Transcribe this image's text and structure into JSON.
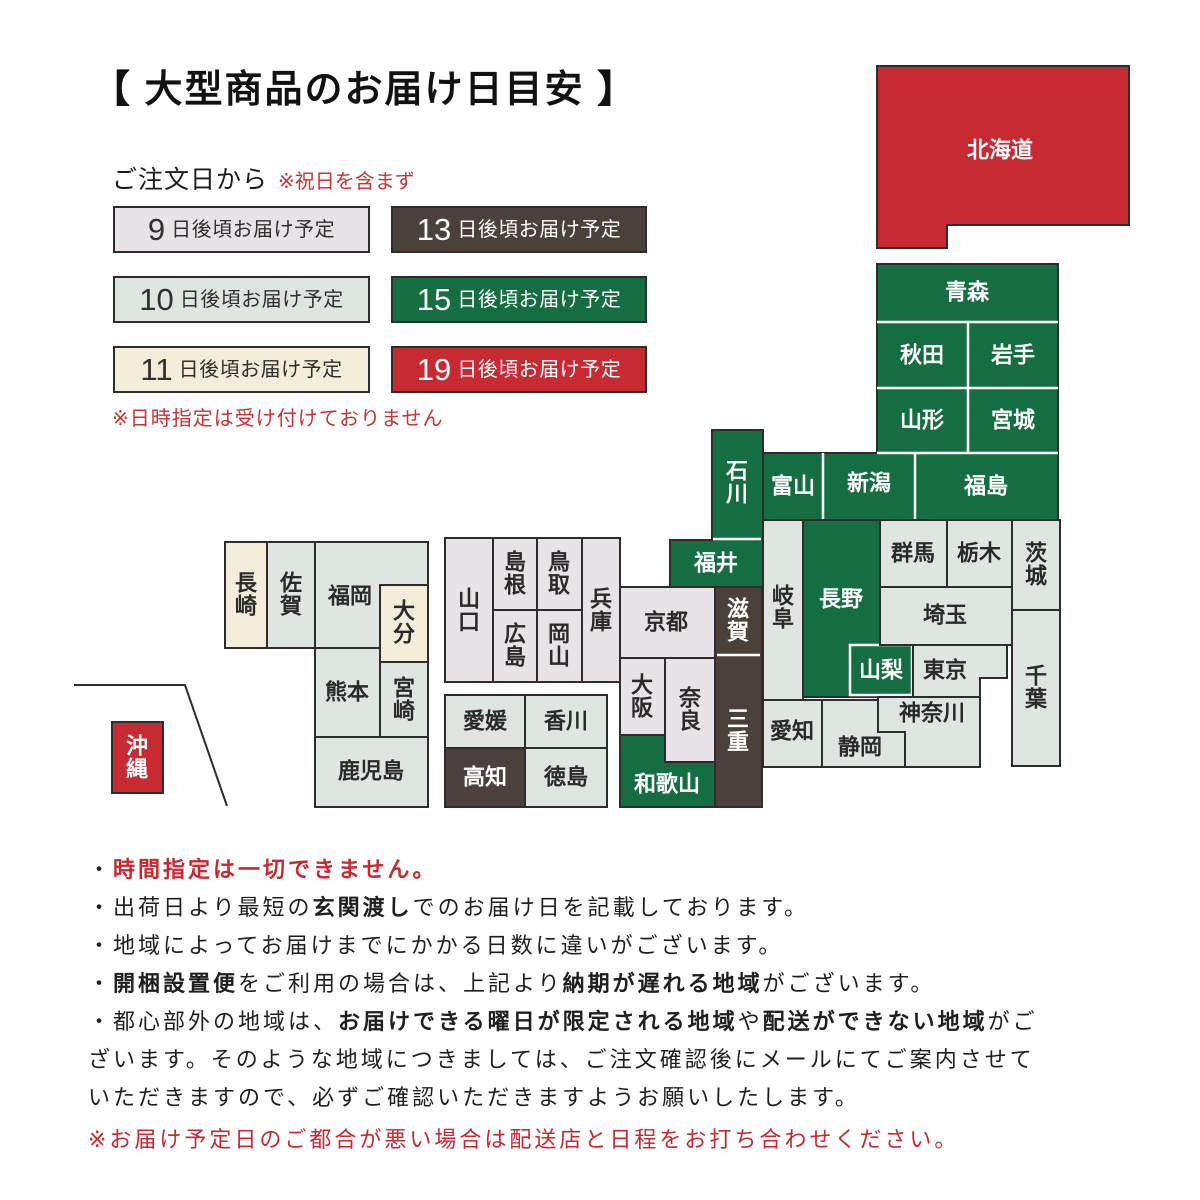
{
  "title": "【 大型商品のお届け日目安 】",
  "legend": {
    "heading": "ご注文日から",
    "heading_note": "※祝日を含まず",
    "items": [
      {
        "days": "9",
        "label": "日後頃お届け予定",
        "cat": "d9"
      },
      {
        "days": "13",
        "label": "日後頃お届け予定",
        "cat": "d13"
      },
      {
        "days": "10",
        "label": "日後頃お届け予定",
        "cat": "d10"
      },
      {
        "days": "15",
        "label": "日後頃お届け予定",
        "cat": "d15"
      },
      {
        "days": "11",
        "label": "日後頃お届け予定",
        "cat": "d11"
      },
      {
        "days": "19",
        "label": "日後頃お届け予定",
        "cat": "d19"
      }
    ],
    "footnote": "※日時指定は受け付けておりません"
  },
  "colors": {
    "d9": "#e8e3e7",
    "d10": "#dfe6e1",
    "d11": "#f4edda",
    "d13": "#4b403a",
    "d15": "#156e41",
    "d19": "#c82a32",
    "border": "#2d2d2d",
    "dark_text": "#2f2f2f",
    "light_text": "#ffffff",
    "red_text": "#c9282e"
  },
  "map": {
    "prefectures": [
      {
        "id": "aomori",
        "name": "青森",
        "cat": "d15"
      },
      {
        "id": "akita",
        "name": "秋田",
        "cat": "d15"
      },
      {
        "id": "iwate",
        "name": "岩手",
        "cat": "d15"
      },
      {
        "id": "yamagata",
        "name": "山形",
        "cat": "d15"
      },
      {
        "id": "miyagi",
        "name": "宮城",
        "cat": "d15"
      },
      {
        "id": "toyama",
        "name": "富山",
        "cat": "d15"
      },
      {
        "id": "niigata",
        "name": "新潟",
        "cat": "d15"
      },
      {
        "id": "fukushima",
        "name": "福島",
        "cat": "d15"
      },
      {
        "id": "ishikawa",
        "name": "石川",
        "cat": "d15"
      },
      {
        "id": "fukui",
        "name": "福井",
        "cat": "d15"
      },
      {
        "id": "shiga",
        "name": "滋賀",
        "cat": "d13"
      },
      {
        "id": "mie",
        "name": "三重",
        "cat": "d13"
      },
      {
        "id": "hokkaido",
        "name": "北海道",
        "cat": "d19"
      },
      {
        "id": "okinawa",
        "name": "沖縄",
        "cat": "d19"
      },
      {
        "id": "nagano",
        "name": "長野",
        "cat": "d15"
      },
      {
        "id": "yamanashi",
        "name": "山梨",
        "cat": "d15"
      },
      {
        "id": "wakayama",
        "name": "和歌山",
        "cat": "d15"
      },
      {
        "id": "gifu",
        "name": "岐阜",
        "cat": "d10"
      },
      {
        "id": "aichi",
        "name": "愛知",
        "cat": "d10"
      },
      {
        "id": "shizuoka",
        "name": "静岡",
        "cat": "d10"
      },
      {
        "id": "kanagawa",
        "name": "神奈川",
        "cat": "d10"
      },
      {
        "id": "tokyo",
        "name": "東京",
        "cat": "d10"
      },
      {
        "id": "saitama",
        "name": "埼玉",
        "cat": "d10"
      },
      {
        "id": "gunma",
        "name": "群馬",
        "cat": "d10"
      },
      {
        "id": "tochigi",
        "name": "栃木",
        "cat": "d10"
      },
      {
        "id": "ibaraki",
        "name": "茨城",
        "cat": "d10"
      },
      {
        "id": "chiba",
        "name": "千葉",
        "cat": "d10"
      },
      {
        "id": "kyoto",
        "name": "京都",
        "cat": "d9"
      },
      {
        "id": "osaka",
        "name": "大阪",
        "cat": "d9"
      },
      {
        "id": "nara",
        "name": "奈良",
        "cat": "d9"
      },
      {
        "id": "hyogo",
        "name": "兵庫",
        "cat": "d9"
      },
      {
        "id": "tottori",
        "name": "鳥取",
        "cat": "d9"
      },
      {
        "id": "okayama",
        "name": "岡山",
        "cat": "d9"
      },
      {
        "id": "shimane",
        "name": "島根",
        "cat": "d9"
      },
      {
        "id": "hiroshima",
        "name": "広島",
        "cat": "d9"
      },
      {
        "id": "yamaguchi",
        "name": "山口",
        "cat": "d9"
      },
      {
        "id": "ehime",
        "name": "愛媛",
        "cat": "d10"
      },
      {
        "id": "kagawa",
        "name": "香川",
        "cat": "d10"
      },
      {
        "id": "kochi",
        "name": "高知",
        "cat": "d13"
      },
      {
        "id": "tokushima",
        "name": "徳島",
        "cat": "d10"
      },
      {
        "id": "nagasaki",
        "name": "長崎",
        "cat": "d11"
      },
      {
        "id": "saga",
        "name": "佐賀",
        "cat": "d10"
      },
      {
        "id": "fukuoka",
        "name": "福岡",
        "cat": "d10"
      },
      {
        "id": "oita",
        "name": "大分",
        "cat": "d11"
      },
      {
        "id": "kumamoto",
        "name": "熊本",
        "cat": "d10"
      },
      {
        "id": "miyazaki",
        "name": "宮崎",
        "cat": "d10"
      },
      {
        "id": "kagoshima",
        "name": "鹿児島",
        "cat": "d10"
      }
    ]
  },
  "notes": {
    "lines": [
      {
        "segments": [
          {
            "t": "・",
            "s": ""
          },
          {
            "t": "時間指定は一切できません。",
            "s": "red-bold"
          }
        ]
      },
      {
        "segments": [
          {
            "t": "・出荷日より最短の",
            "s": ""
          },
          {
            "t": "玄関渡し",
            "s": "bold"
          },
          {
            "t": "でのお届け日を記載しております。",
            "s": ""
          }
        ]
      },
      {
        "segments": [
          {
            "t": "・地域によってお届けまでにかかる日数に違いがございます。",
            "s": ""
          }
        ]
      },
      {
        "segments": [
          {
            "t": "・",
            "s": ""
          },
          {
            "t": "開梱設置便",
            "s": "bold"
          },
          {
            "t": "をご利用の場合は、上記より",
            "s": ""
          },
          {
            "t": "納期が遅れる地域",
            "s": "bold"
          },
          {
            "t": "がございます。",
            "s": ""
          }
        ]
      },
      {
        "segments": [
          {
            "t": "・都心部外の地域は、",
            "s": ""
          },
          {
            "t": "お届けできる曜日が限定される地域",
            "s": "bold"
          },
          {
            "t": "や",
            "s": ""
          },
          {
            "t": "配送ができない地域",
            "s": "bold"
          },
          {
            "t": "がご",
            "s": ""
          }
        ]
      },
      {
        "segments": [
          {
            "t": "ざいます。そのような地域につきましては、ご注文確認後にメールにてご案内させて",
            "s": ""
          }
        ]
      },
      {
        "segments": [
          {
            "t": "いただきますので、必ずご確認いただきますようお願いしたします。",
            "s": ""
          }
        ]
      },
      {
        "segments": [
          {
            "t": "※お届け予定日のご都合が悪い場合は配送店と日程をお打ち合わせください。",
            "s": "red"
          }
        ]
      }
    ]
  }
}
